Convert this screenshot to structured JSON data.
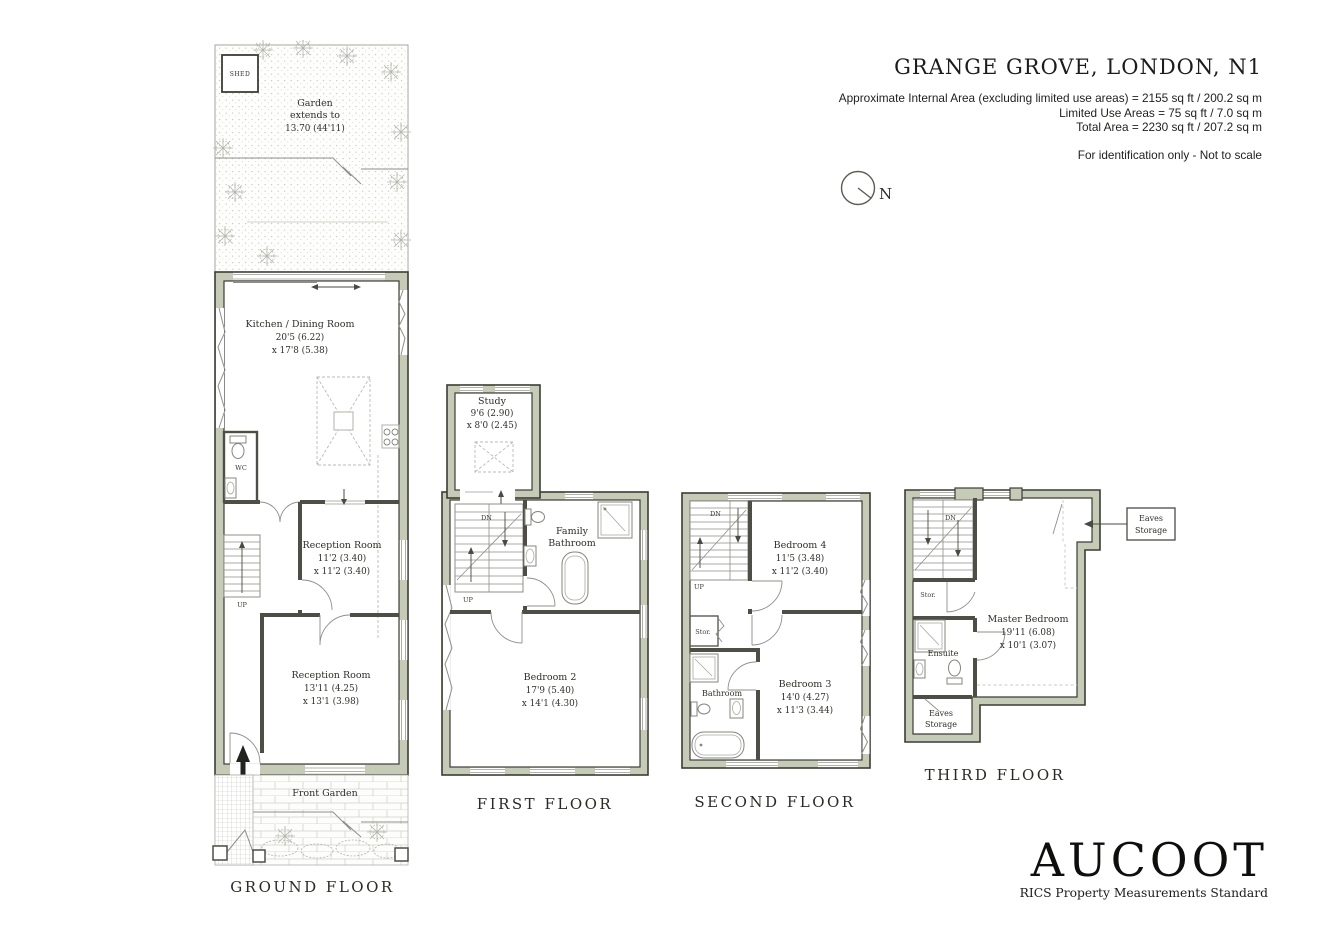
{
  "header": {
    "title": "GRANGE GROVE, LONDON, N1",
    "area_line1": "Approximate Internal Area (excluding limited use areas)  = 2155 sq ft / 200.2 sq m",
    "area_line2": "Limited Use Areas = 75 sq ft / 7.0 sq m",
    "area_line3": "Total Area = 2230 sq ft / 207.2 sq m",
    "disclaimer": "For identification only - Not to scale",
    "compass_n": "N"
  },
  "ground": {
    "label": "GROUND FLOOR",
    "shed": "SHED",
    "garden_line1": "Garden",
    "garden_line2": "extends to",
    "garden_line3": "13.70 (44'11)",
    "kitchen_name": "Kitchen / Dining Room",
    "kitchen_dim1": "20'5 (6.22)",
    "kitchen_dim2": "x 17'8 (5.38)",
    "wc": "WC",
    "up": "UP",
    "reception1_name": "Reception Room",
    "reception1_dim1": "11'2 (3.40)",
    "reception1_dim2": "x 11'2 (3.40)",
    "reception2_name": "Reception Room",
    "reception2_dim1": "13'11 (4.25)",
    "reception2_dim2": "x 13'1 (3.98)",
    "front_garden": "Front Garden"
  },
  "first": {
    "label": "FIRST FLOOR",
    "study_name": "Study",
    "study_dim1": "9'6 (2.90)",
    "study_dim2": "x 8'0 (2.45)",
    "dn": "DN",
    "up": "UP",
    "bath_line1": "Family",
    "bath_line2": "Bathroom",
    "bedroom2_name": "Bedroom 2",
    "bedroom2_dim1": "17'9 (5.40)",
    "bedroom2_dim2": "x 14'1 (4.30)"
  },
  "second": {
    "label": "SECOND FLOOR",
    "dn": "DN",
    "up": "UP",
    "stor": "Stor.",
    "bathroom": "Bathroom",
    "bedroom4_name": "Bedroom 4",
    "bedroom4_dim1": "11'5 (3.48)",
    "bedroom4_dim2": "x 11'2 (3.40)",
    "bedroom3_name": "Bedroom 3",
    "bedroom3_dim1": "14'0 (4.27)",
    "bedroom3_dim2": "x 11'3 (3.44)"
  },
  "third": {
    "label": "THIRD FLOOR",
    "dn": "DN",
    "stor": "Stor.",
    "ensuite": "Ensuite",
    "master_name": "Master Bedroom",
    "master_dim1": "19'11 (6.08)",
    "master_dim2": "x 10'1 (3.07)",
    "eaves_room_line1": "Eaves",
    "eaves_room_line2": "Storage",
    "callout_line1": "Eaves",
    "callout_line2": "Storage"
  },
  "footer": {
    "brand": "AUCOOT",
    "tagline": "RICS Property Measurements Standard"
  },
  "colors": {
    "wall_fill": "#c5cbb7",
    "wall_outline": "#3c3c35",
    "partition": "#4e4e47",
    "text": "#2f2e29"
  }
}
